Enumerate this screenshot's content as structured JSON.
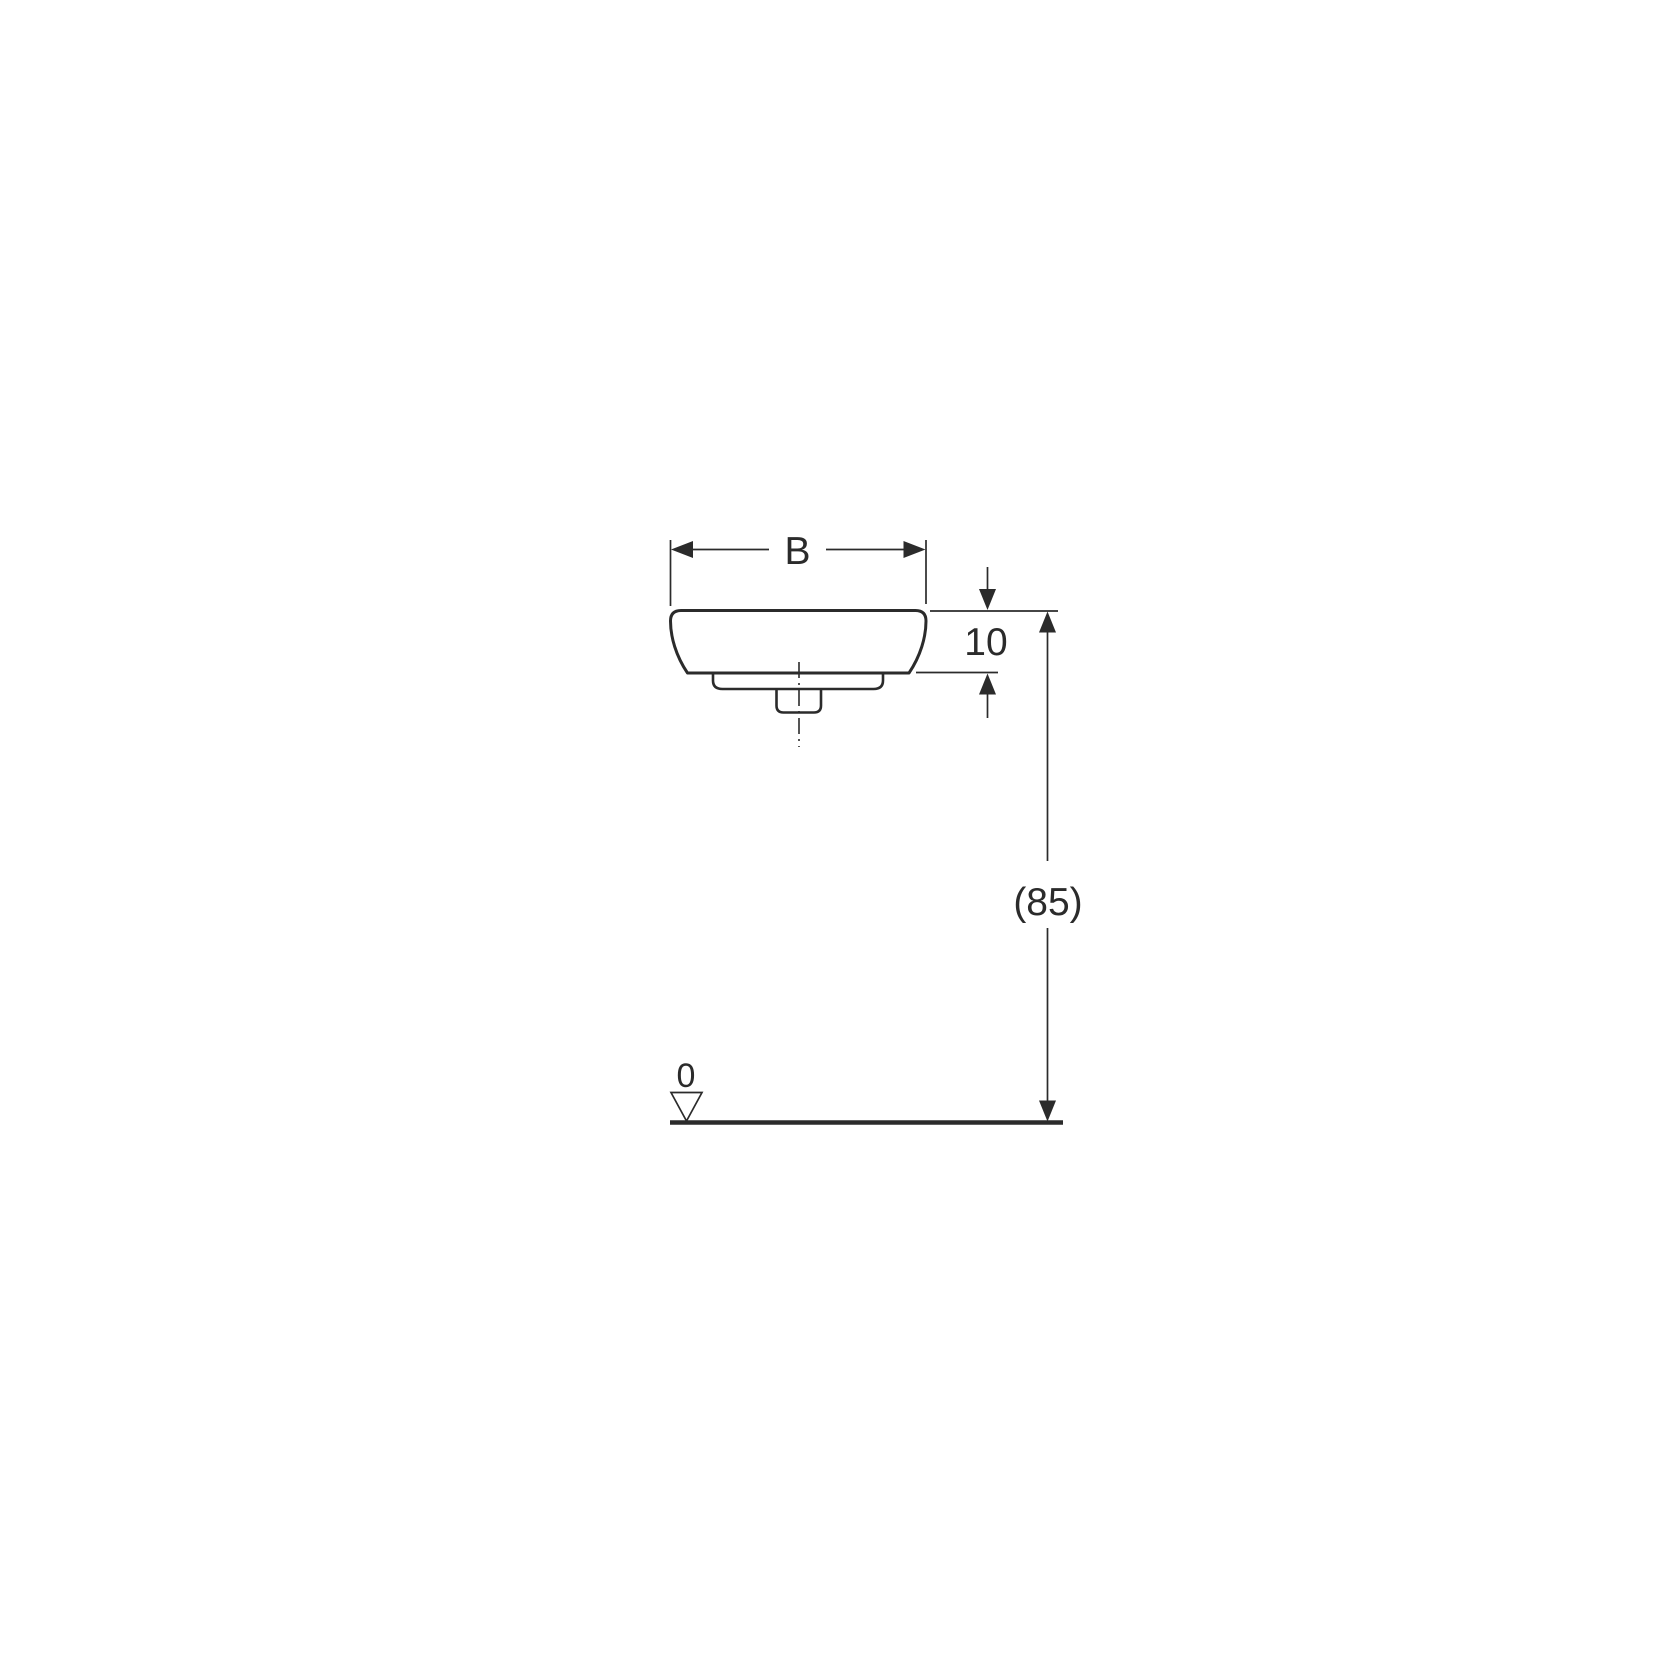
{
  "drawing": {
    "type": "technical-dimension-drawing",
    "labels": {
      "width_dim": "B",
      "rim_height_dim": "10",
      "install_height_dim": "(85)",
      "datum_level": "0"
    },
    "colors": {
      "line": "#2b2b2b",
      "background": "#ffffff"
    }
  }
}
